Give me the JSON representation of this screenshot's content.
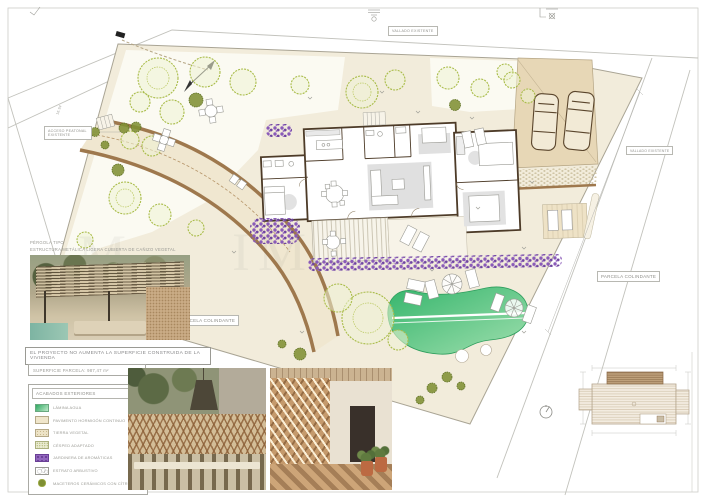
{
  "annotations": {
    "pergola_title": "PÉRGOLA TIPO",
    "pergola_subtitle": "ESTRUCTURA METÁLICA LIGERA CUBIERTA DE CAÑIZO VEGETAL",
    "note": "EL PROYECTO NO AUMENTA LA SUPERFICIE CONSTRUIDA DE LA VIVIENDA",
    "surface": "SUPERFICIE PARCELA: 987,47 m²",
    "neighbor_left": "PARCELA COLINDANTE",
    "neighbor_right": "PARCELA COLINDANTE",
    "fence_top": "VALLADO EXISTENTE",
    "fence_right": "VALLADO EXISTENTE",
    "access_line1": "ACCESO PEATONAL",
    "access_line2": "EXISTENTE",
    "level_mark": "16.94"
  },
  "legend": {
    "title": "ACABADOS EXTERIORES",
    "items": [
      {
        "label": "LÁMINA AGUA",
        "swatch": "water"
      },
      {
        "label": "PAVIMENTO HORMIGÓN CONTINUO",
        "swatch": "concrete"
      },
      {
        "label": "TIERRA VEGETAL",
        "swatch": "soil"
      },
      {
        "label": "CÉSPED ADAPTADO",
        "swatch": "grass"
      },
      {
        "label": "JARDINERA DE AROMÁTICAS",
        "swatch": "aromatics"
      },
      {
        "label": "ESTRATO ARBUSTIVO",
        "swatch": "shrub"
      },
      {
        "label": "MACETEROS CERÁMICOS CON CÍTRICOS",
        "swatch": "citrus"
      }
    ]
  },
  "watermark": [
    "M",
    "I",
    "M"
  ],
  "colors": {
    "hardscape": "#f2ecdb",
    "parking": "#e7d7b6",
    "path_brown": "#9e784d",
    "tree_green": "#a9bc49",
    "lavender": "#8a5bb8",
    "pool_green": "#3fbf72",
    "wall_brown": "#4d3b28"
  }
}
